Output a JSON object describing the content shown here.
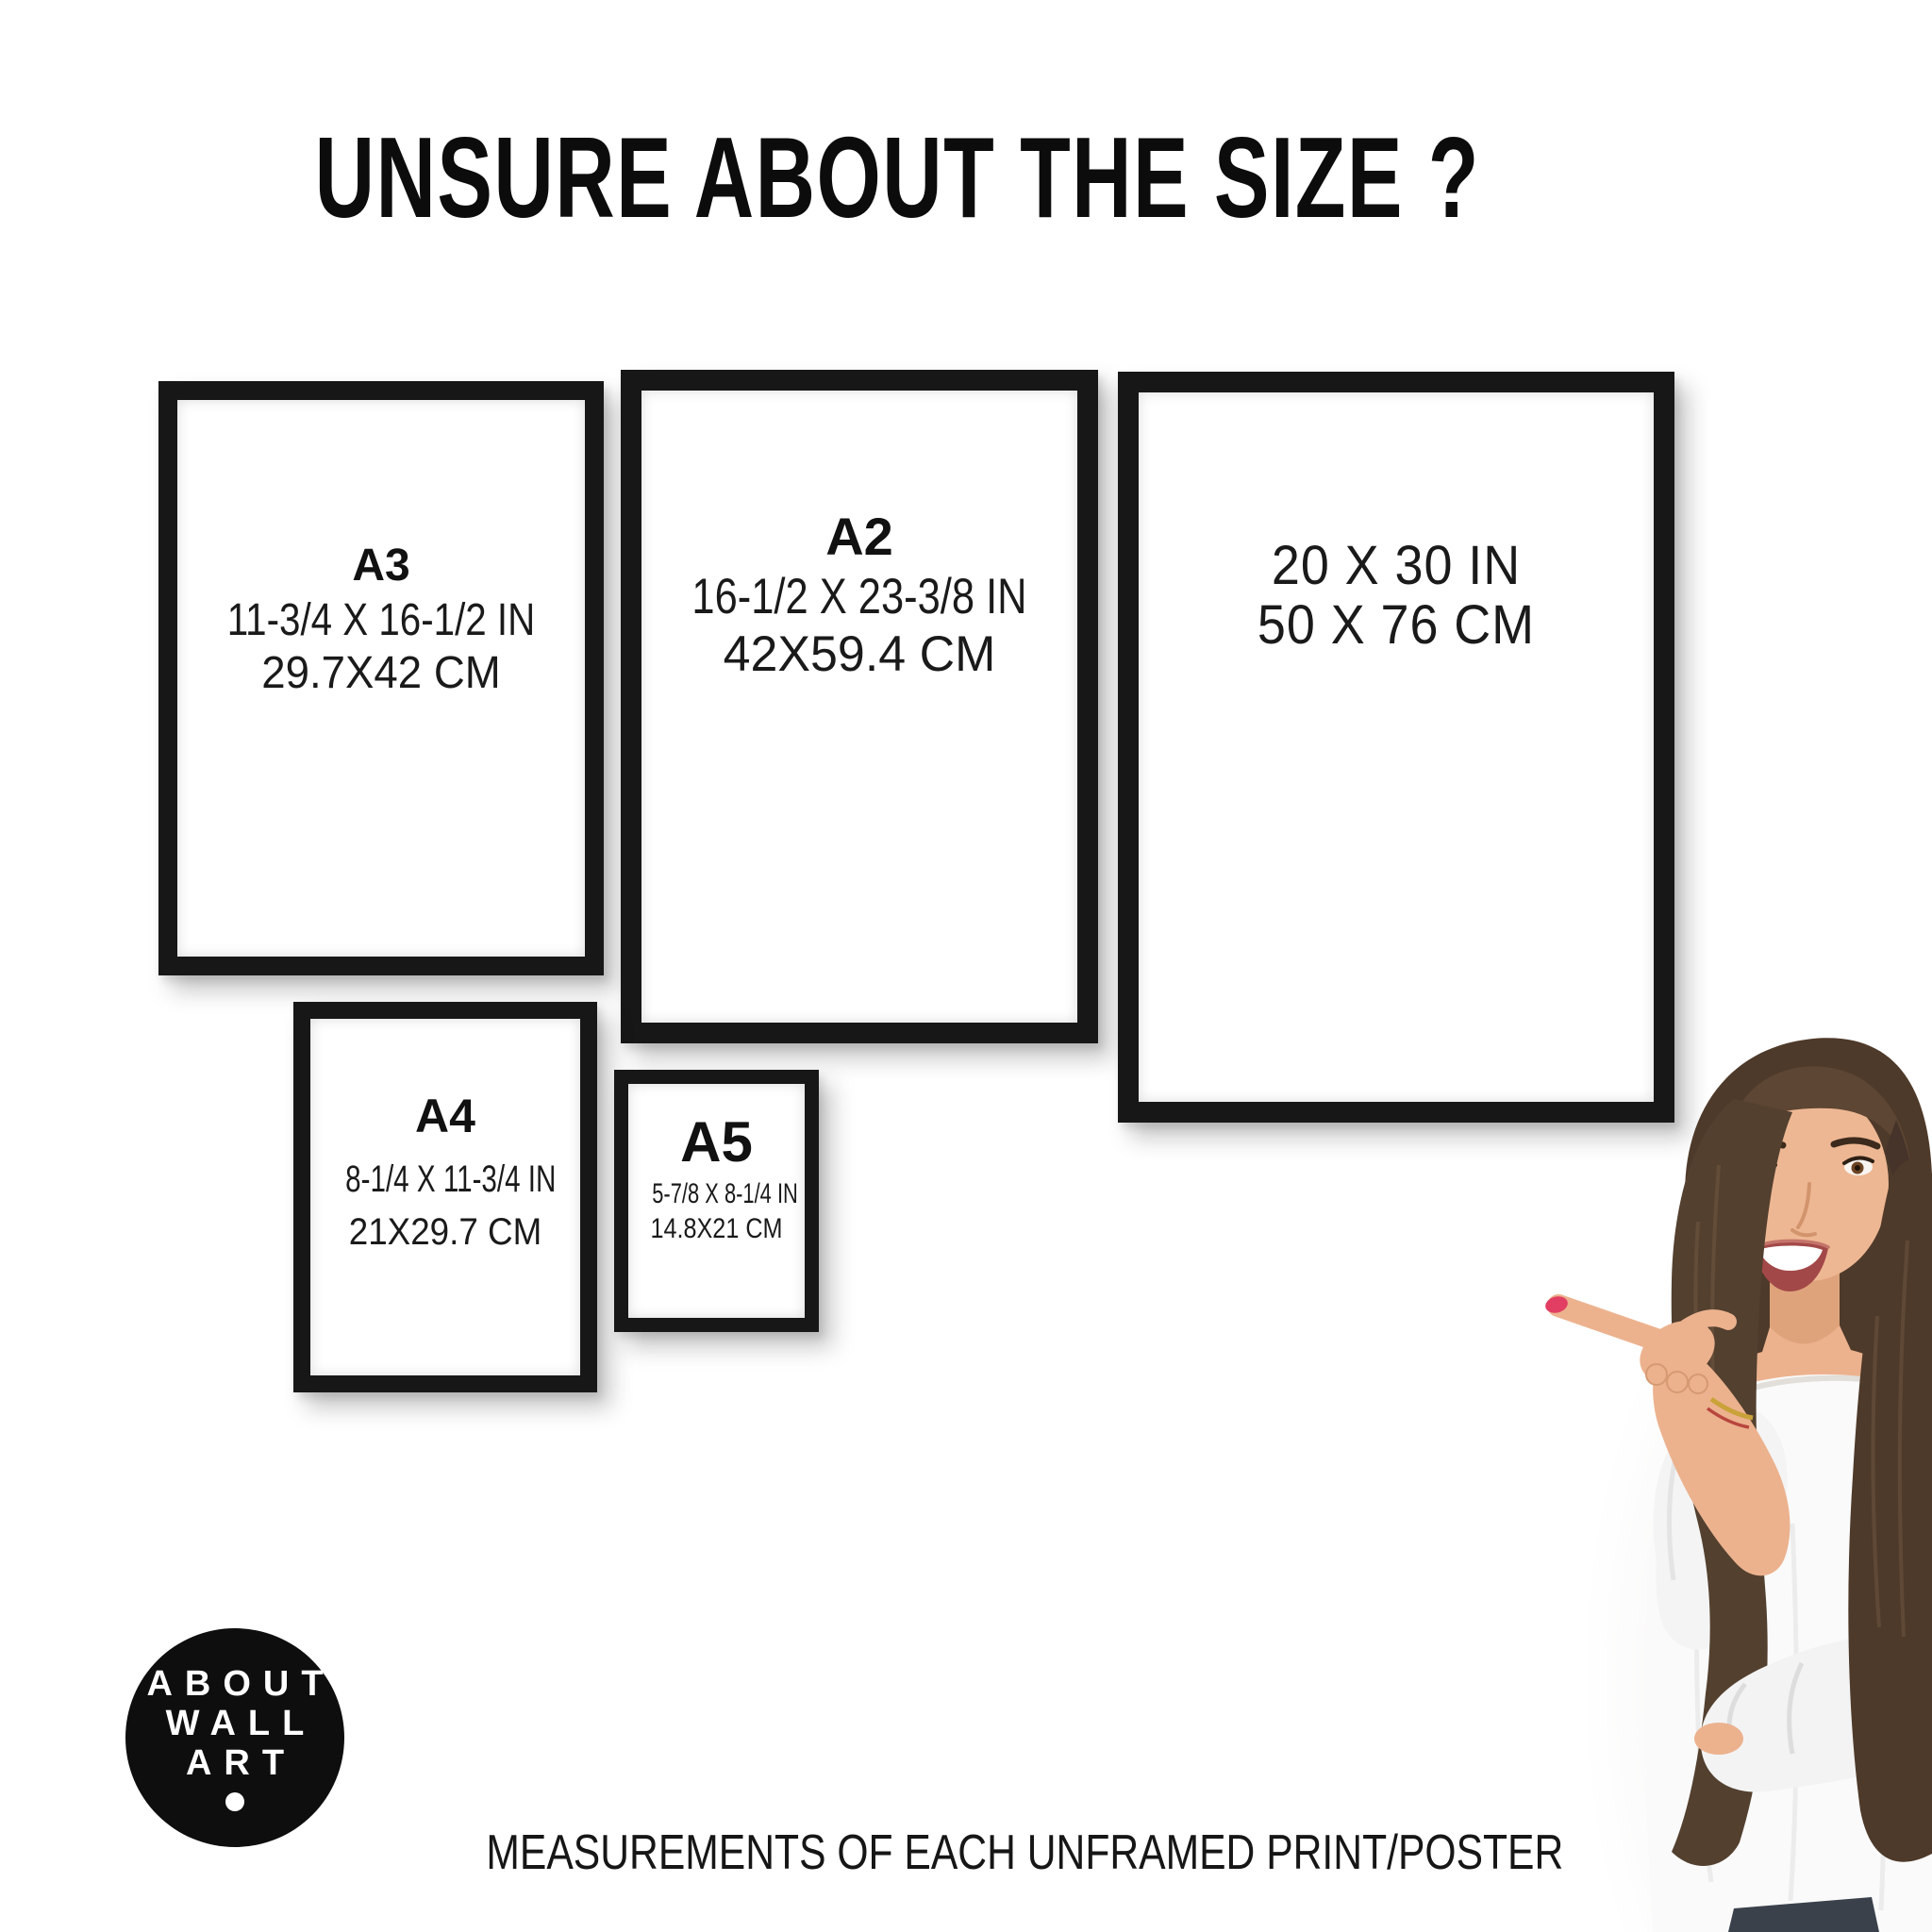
{
  "title": "UNSURE ABOUT THE SIZE ?",
  "frames": [
    {
      "name": "A3 frame",
      "label": "A3",
      "size_in": "11-3/4 X 16-1/2 IN",
      "size_cm": "29.7X42 CM"
    },
    {
      "name": "A2 frame",
      "label": "A2",
      "size_in": "16-1/2 X 23-3/8 IN",
      "size_cm": "42X59.4 CM"
    },
    {
      "name": "20x30 frame",
      "label": "",
      "size_in": "20 X 30 IN",
      "size_cm": "50 X 76 CM"
    },
    {
      "name": "A4 frame",
      "label": "A4",
      "size_in": "8-1/4 X 11-3/4 IN",
      "size_cm": "21X29.7 CM"
    },
    {
      "name": "A5 frame",
      "label": "A5",
      "size_in": "5-7/8 X 8-1/4 IN",
      "size_cm": "14.8X21 CM"
    }
  ],
  "logo": {
    "lines": [
      "ABOUT",
      "WALL",
      "ART"
    ]
  },
  "caption": "MEASUREMENTS OF EACH UNFRAMED PRINT/POSTER",
  "colors": {
    "background": "#ffffff",
    "frame_black": "#171717",
    "text": "#141414",
    "logo_background": "#0e0e0e",
    "logo_text": "#ffffff",
    "hair": "#4e3a2a",
    "skin": "#ecb28e",
    "blouse": "#fafafa",
    "nail_polish": "#e23e63",
    "jeans": "#3a414b"
  },
  "illustration": {
    "subject": "smiling woman with long brown hair pointing left",
    "pointing_direction": "left",
    "nail_polish": "red",
    "clothing": "white off-shoulder blouse"
  }
}
